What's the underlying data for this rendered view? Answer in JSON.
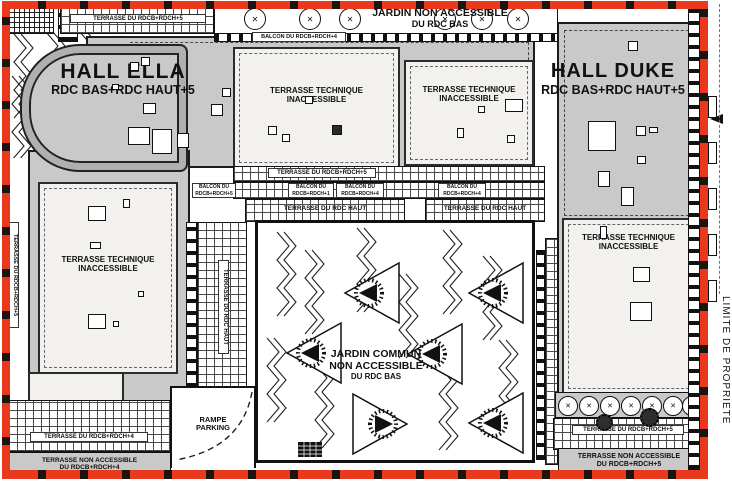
{
  "colors": {
    "property_line": "#e8391d",
    "roof_gray": "#c9c9c9",
    "terrace_panel": "#f2f1ee",
    "line_black": "#111111"
  },
  "boundary": {
    "label": "LIMITE DE PROPRIETE"
  },
  "halls": {
    "ella": {
      "name": "HALL ELLA",
      "levels": "RDC BAS+RDC HAUT+5"
    },
    "duke": {
      "name": "HALL DUKE",
      "levels": "RDC BAS+RDC HAUT+5"
    }
  },
  "top_garden": {
    "line1": "JARDIN NON ACCESSIBLE",
    "line2": "DU RDC BAS"
  },
  "central_garden": {
    "line1": "JARDIN COMMUN",
    "line2": "NON ACCESSIBLE",
    "line3": "DU RDC BAS"
  },
  "technical_terrace": {
    "line1": "TERRASSE TECHNIQUE",
    "line2": "INACCESSIBLE"
  },
  "terraces": {
    "top_left": "TERRASSE DU RDCB+RDCH+5",
    "left_edge": "TERRASSE DU RDCB+RDCH+5",
    "mid": "TERRASSE DU RDCB+RDCH+5",
    "rdc_haut": "TERRASSE DU RDC HAUT",
    "bottom_left": "TERRASSE DU RDCB+RDCH+4",
    "bottom_right": "TERRASSE DU RDCB+RDCH+5"
  },
  "non_accessible_bands": {
    "left": {
      "line1": "TERRASSE NON ACCESSIBLE",
      "line2": "DU RDCB+RDCH+4"
    },
    "right": {
      "line1": "TERRASSE NON ACCESSIBLE",
      "line2": "DU RDCB+RDCH+5"
    }
  },
  "balconies": {
    "top": "BALCON DU RDCB+RDCH+4",
    "mid_1": {
      "line1": "BALCON DU",
      "line2": "RDCB+RDCH+5"
    },
    "mid_2": {
      "line1": "BALCON DU",
      "line2": "RDCB+RDCH+1"
    },
    "mid_3": {
      "line1": "BALCON DU",
      "line2": "RDCB+RDCH+4"
    },
    "mid_4": {
      "line1": "BALCON DU",
      "line2": "RDCB+RDCH+4"
    }
  },
  "parking_ramp": {
    "line1": "RAMPE",
    "line2": "PARKING"
  },
  "tree_symbol": "✕"
}
